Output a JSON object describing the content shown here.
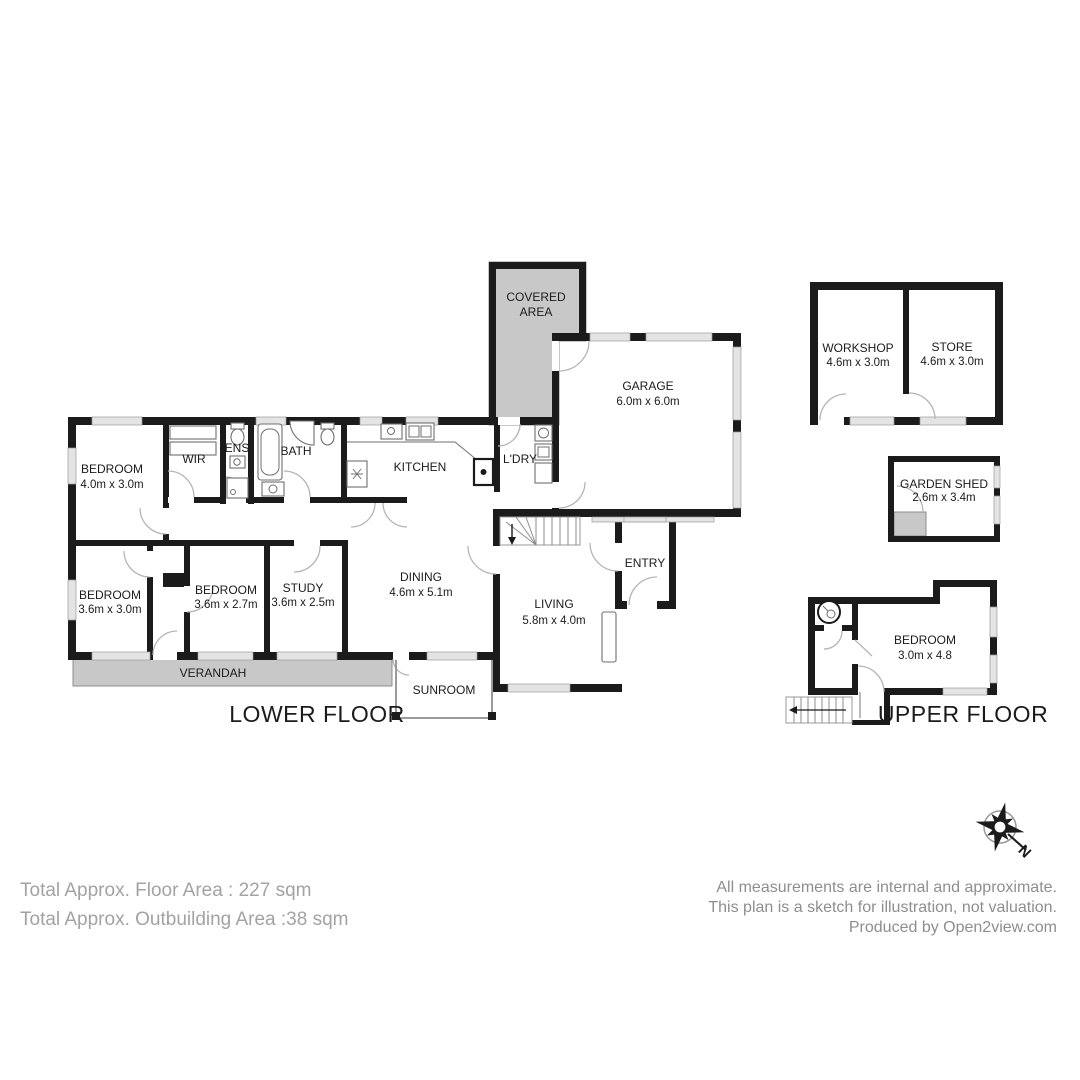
{
  "plan": {
    "lower_floor_label": "LOWER FLOOR",
    "upper_floor_label": "UPPER FLOOR",
    "compass_north": "N",
    "colors": {
      "wall": "#1b1b1b",
      "shaded": "#c8c8c8",
      "window": "#e4e4e4"
    },
    "rooms": {
      "bedroom1": {
        "name": "BEDROOM",
        "dims": "4.0m x 3.0m"
      },
      "wir": {
        "name": "WIR"
      },
      "ens": {
        "name": "ENS"
      },
      "bath": {
        "name": "BATH"
      },
      "kitchen": {
        "name": "KITCHEN"
      },
      "ldry": {
        "name": "L'DRY"
      },
      "covered_area": {
        "line1": "COVERED",
        "line2": "AREA"
      },
      "garage": {
        "name": "GARAGE",
        "dims": "6.0m x 6.0m"
      },
      "dining": {
        "name": "DINING",
        "dims": "4.6m x 5.1m"
      },
      "living": {
        "name": "LIVING",
        "dims": "5.8m x 4.0m"
      },
      "entry": {
        "name": "ENTRY"
      },
      "bedroom2": {
        "name": "BEDROOM",
        "dims": "3.6m x 3.0m"
      },
      "bedroom3": {
        "name": "BEDROOM",
        "dims": "3.6m x 2.7m"
      },
      "study": {
        "name": "STUDY",
        "dims": "3.6m x 2.5m"
      },
      "verandah": {
        "name": "VERANDAH"
      },
      "sunroom": {
        "name": "SUNROOM"
      },
      "workshop": {
        "name": "WORKSHOP",
        "dims": "4.6m x 3.0m"
      },
      "store": {
        "name": "STORE",
        "dims": "4.6m x 3.0m"
      },
      "garden_shed": {
        "name": "GARDEN SHED",
        "dims": "2.6m x 3.4m"
      },
      "bedroom_upper": {
        "name": "BEDROOM",
        "dims": "3.0m x 4.8"
      }
    }
  },
  "footer": {
    "left": {
      "line1": "Total Approx. Floor Area : 227 sqm",
      "line2": "Total Approx. Outbuilding Area :38 sqm"
    },
    "right": {
      "line1": "All measurements are internal and approximate.",
      "line2": "This plan is a sketch for illustration, not valuation.",
      "line3": "Produced by Open2view.com"
    }
  }
}
